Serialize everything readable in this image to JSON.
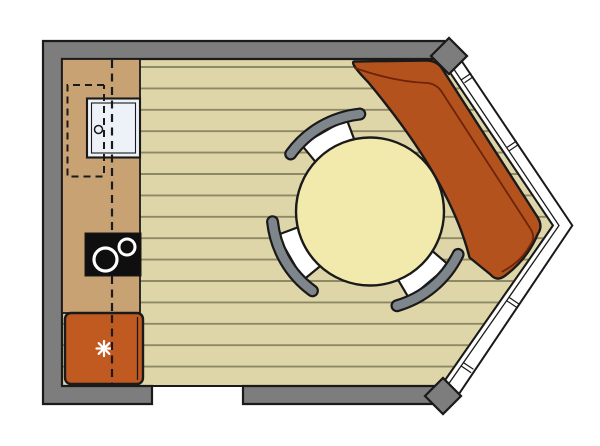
{
  "plan": {
    "kind": "kitchen-dining floor plan with corner bay window",
    "fridge_symbol_icon": "snowflake-asterisk",
    "chair_count": "3"
  },
  "colors": {
    "background": "#ffffff",
    "outline": "#1a1a1a",
    "wall": "#7d7d7d",
    "floor": "#ded6a8",
    "floor_stripe": "#8d8966",
    "counter": "#c8a273",
    "sink": "#edf2f9",
    "cooktop": "#0f0f0f",
    "burner": "#ffffff",
    "fridge": "#c15a20",
    "fridge_symbol": "#ffffff",
    "sofa": "#b4521e",
    "sofa_seam": "#6d2408",
    "table": "#f2e9ac",
    "chair_seat": "#ffffff",
    "chair_back": "#7e868c",
    "window": "#ffffff",
    "dash": "#1a1a1a",
    "none": "none"
  }
}
